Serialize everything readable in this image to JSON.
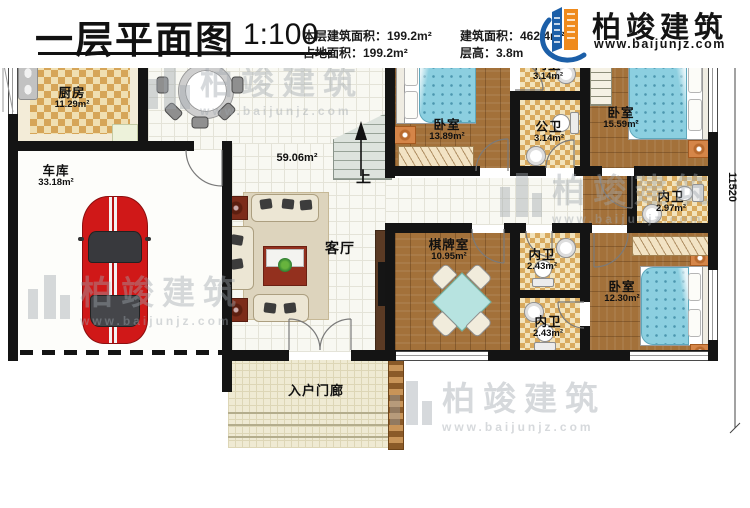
{
  "plan": {
    "dimension_top": "20000",
    "dimension_right": "11520",
    "stairs_up": "上"
  },
  "rooms": {
    "kitchen": {
      "name": "厨房",
      "area": "11.29m²"
    },
    "dining": {
      "name": "餐厅",
      "area": ""
    },
    "garage": {
      "name": "车库",
      "area": "33.18m²"
    },
    "living": {
      "name": "客厅",
      "area": "59.06m²"
    },
    "bedroom1": {
      "name": "卧室",
      "area": "13.89m²"
    },
    "ensuite1": {
      "name": "内卫",
      "area": "3.14m²"
    },
    "public_bath": {
      "name": "公卫",
      "area": "3.14m²"
    },
    "bedroom2": {
      "name": "卧室",
      "area": "15.59m²"
    },
    "ensuite2": {
      "name": "内卫",
      "area": "2.97m²"
    },
    "chess_room": {
      "name": "棋牌室",
      "area": "10.95m²"
    },
    "ensuite3": {
      "name": "内卫",
      "area": "2.43m²"
    },
    "ensuite4": {
      "name": "内卫",
      "area": "2.43m²"
    },
    "bedroom3": {
      "name": "卧室",
      "area": "12.30m²"
    },
    "porch": {
      "name": "入户门廊",
      "area": ""
    }
  },
  "title_block": {
    "title": "一层平面图",
    "scale": "1:100",
    "stat1": "本层建筑面积：199.2m²",
    "stat2": "占地面积：199.2m²",
    "stat3": "建筑面积：462.4m²",
    "stat4": "层高：3.8m"
  },
  "brand": {
    "name": "柏竣建筑",
    "url": "www.baijunjz.com"
  },
  "watermark": {
    "name": "柏竣建筑",
    "url": "www.baijunjz.com"
  },
  "colors": {
    "wall": "#141414",
    "wood_floor": "#a3713a",
    "checker_tile": "#d9aa5e",
    "bed_blue": "#8ccfe0",
    "brand_blue": "#1c5fa8",
    "brand_orange": "#ef8a1c"
  }
}
